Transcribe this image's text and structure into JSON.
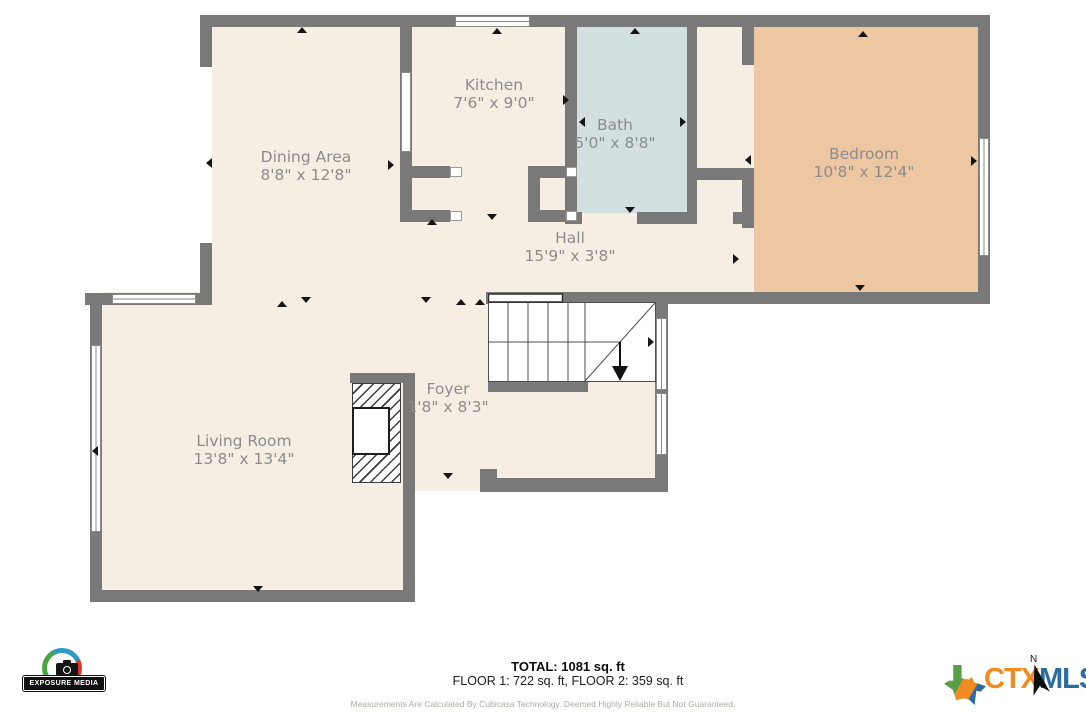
{
  "plan": {
    "rooms": [
      {
        "name": "Kitchen",
        "dimensions": "7'6\" x 9'0\""
      },
      {
        "name": "Bath",
        "dimensions": "5'0\" x 8'8\""
      },
      {
        "name": "Dining Area",
        "dimensions": "8'8\" x 12'8\""
      },
      {
        "name": "Bedroom",
        "dimensions": "10'8\" x 12'4\""
      },
      {
        "name": "Hall",
        "dimensions": "15'9\" x 3'8\""
      },
      {
        "name": "Foyer",
        "dimensions": "1'8\" x 8'3\""
      },
      {
        "name": "Living Room",
        "dimensions": "13'8\" x 13'4\""
      }
    ],
    "colors": {
      "floor": "#f6eee3",
      "bath": "#d2e0e2",
      "bedroom": "#edc7a2",
      "wall": "#797979",
      "label_text": "#8c8c8c"
    }
  },
  "footer": {
    "total": "TOTAL: 1081 sq. ft",
    "floors": "FLOOR 1: 722 sq. ft, FLOOR 2: 359 sq. ft",
    "disclaimer": "Measurements Are Calculated By Cubicasa Technology. Deemed Highly Reliable But Not Guaranteed."
  },
  "logos": {
    "photographer": "EXPOSURE MEDIA",
    "ctx": "CTX",
    "mls": "MLS",
    "north_label": "N"
  }
}
